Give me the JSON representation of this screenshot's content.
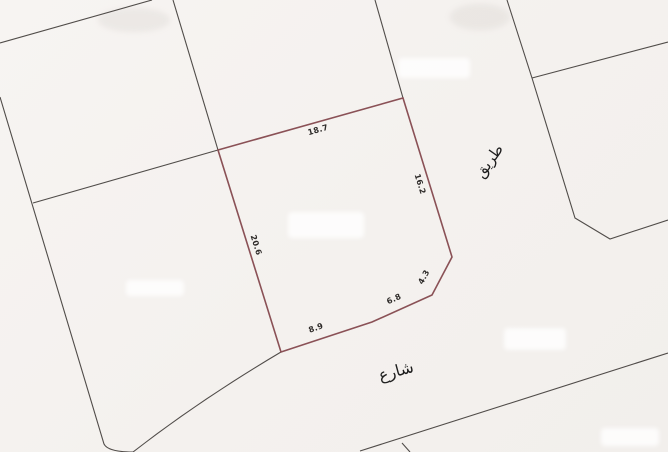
{
  "map": {
    "type": "cadastral-survey-sketch",
    "canvas": {
      "width": 668,
      "height": 452
    },
    "colors": {
      "background": "#f5f2ef",
      "parcel_outline": "#8a5156",
      "boundary_line": "#504c49",
      "dimension_text": "#2e2b29",
      "street_text": "#1d1d1d"
    },
    "parcel": {
      "path": "M218,150 L403,98 L452,257 L432,295 L372,322 L281,352 Z",
      "dimension_labels": [
        {
          "text": "18.7",
          "x": 318,
          "y": 130,
          "angle": -16
        },
        {
          "text": "16.2",
          "x": 420,
          "y": 184,
          "angle": 73
        },
        {
          "text": "4.3",
          "x": 424,
          "y": 277,
          "angle": -62
        },
        {
          "text": "6.8",
          "x": 394,
          "y": 299,
          "angle": -24
        },
        {
          "text": "8.9",
          "x": 316,
          "y": 328,
          "angle": -20
        },
        {
          "text": "20.6",
          "x": 256,
          "y": 245,
          "angle": 73
        }
      ]
    },
    "street_labels": [
      {
        "text": "طريق",
        "x": 489,
        "y": 161,
        "angle": -55,
        "size": 15
      },
      {
        "text": "شارع",
        "x": 396,
        "y": 371,
        "angle": -15,
        "size": 16
      }
    ],
    "boundary_lines": [
      {
        "name": "northwest-parcel-top-edge",
        "path": "M0,43 L152,0"
      },
      {
        "name": "northwest-parcel-right-edge",
        "path": "M173,0 L218,150"
      },
      {
        "name": "northwest-parcel-bottom-edge",
        "path": "M218,150 L33,203"
      },
      {
        "name": "west-parcel-left-edge",
        "path": "M0,97 L104,444 Q108,452 133,452"
      },
      {
        "name": "road-upper-edge-curve",
        "path": "M281,352 Q200,400 133,452"
      },
      {
        "name": "north-parcel-divider",
        "path": "M375,0 L403,98"
      },
      {
        "name": "east-road-boundary",
        "path": "M507,0 L532,78 L575,218 L610,239 L668,220"
      },
      {
        "name": "east-parcel-top-edge",
        "path": "M532,78 L668,42"
      },
      {
        "name": "southeast-road-boundary",
        "path": "M360,451 L668,353"
      },
      {
        "name": "south-parcel-corner-stub",
        "path": "M402,443 L410,452"
      }
    ]
  }
}
